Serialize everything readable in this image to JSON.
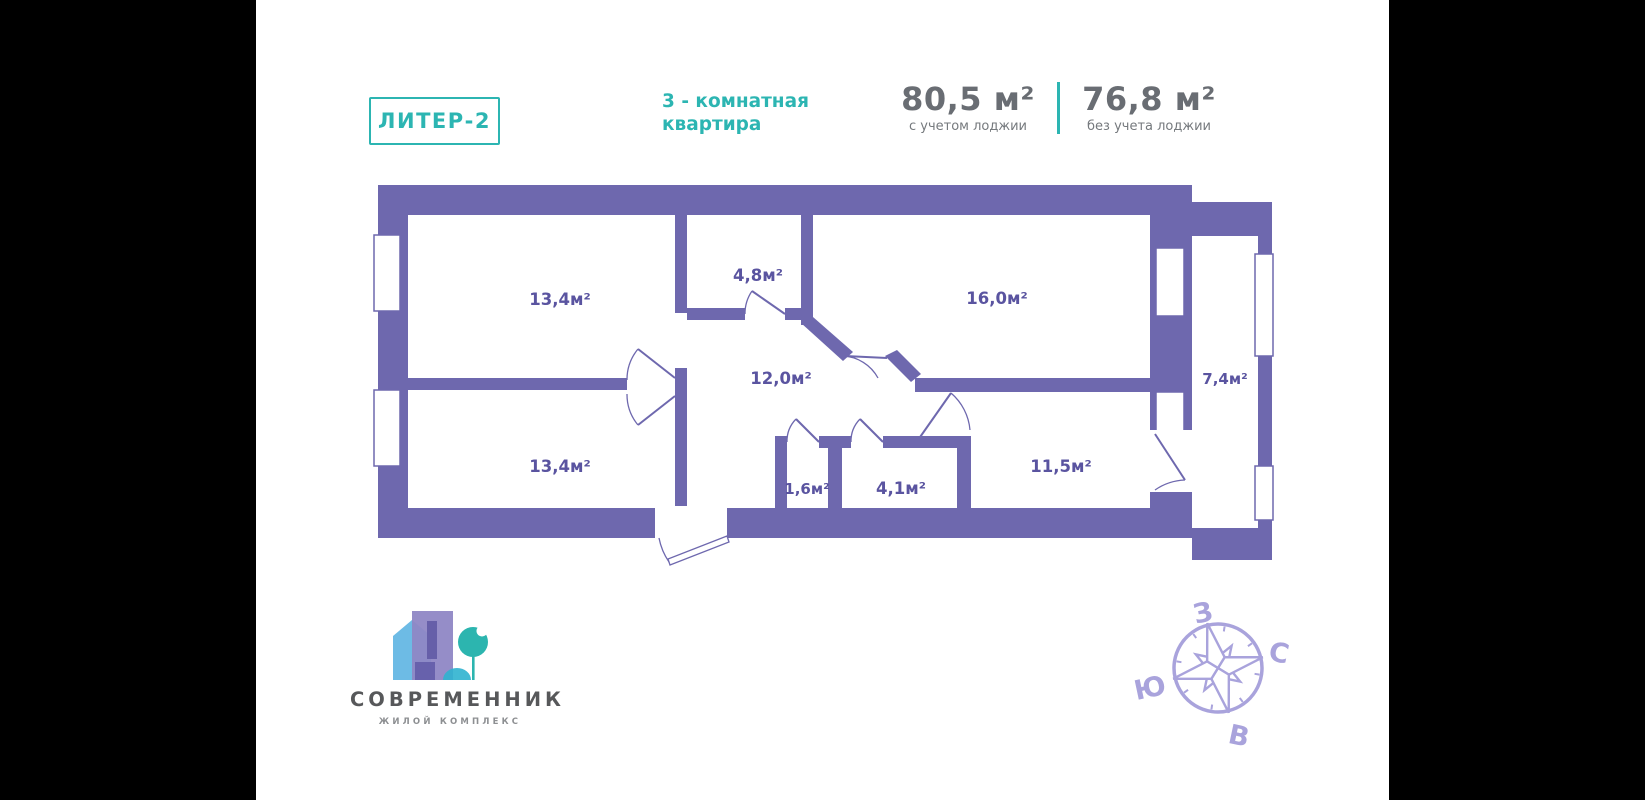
{
  "header": {
    "liter_badge": "ЛИТЕР-2",
    "apartment_type_line1": "3 - комнатная",
    "apartment_type_line2": "квартира",
    "area_with_loggia": {
      "value": "80,5 м²",
      "label": "с учетом лоджии"
    },
    "area_without_loggia": {
      "value": "76,8 м²",
      "label": "без учета лоджии"
    }
  },
  "floor_plan": {
    "rooms": [
      {
        "name": "room-top-left",
        "area": "13,4м²"
      },
      {
        "name": "room-top-middle",
        "area": "4,8м²"
      },
      {
        "name": "room-top-right",
        "area": "16,0м²"
      },
      {
        "name": "hallway",
        "area": "12,0м²"
      },
      {
        "name": "room-bottom-left",
        "area": "13,4м²"
      },
      {
        "name": "wc",
        "area": "1,6м²"
      },
      {
        "name": "bathroom",
        "area": "4,1м²"
      },
      {
        "name": "room-bottom-right",
        "area": "11,5м²"
      },
      {
        "name": "loggia",
        "area": "7,4м²"
      }
    ]
  },
  "logo": {
    "title": "СОВРЕМЕННИК",
    "subtitle": "ЖИЛОЙ КОМПЛЕКС"
  },
  "compass": {
    "west": "З",
    "north": "С",
    "south": "Ю",
    "east": "В"
  },
  "colors": {
    "accent_teal": "#2cb5b2",
    "wall_purple": "#6e68ae",
    "room_label_purple": "#5a54a0",
    "compass_purple": "#a9a3dc",
    "stat_gray": "#696d73"
  }
}
